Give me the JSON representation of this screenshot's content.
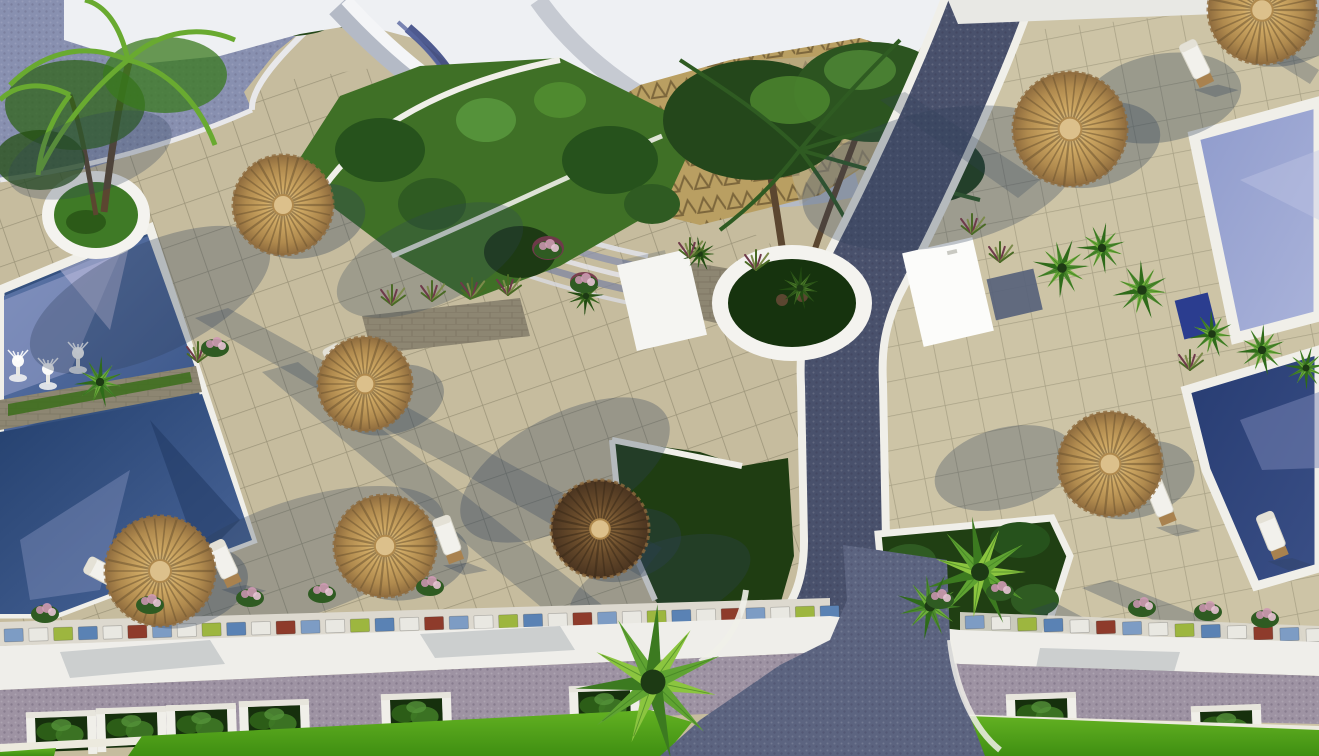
{
  "scene": {
    "type": "aerial-3d-render",
    "subject": "resort pool terrace, top-down view, sunny with long tree shadows"
  },
  "palette": {
    "tile": "#c6bc9e",
    "tile_right": "#cdc4a6",
    "grid_line": "rgba(62,60,40,0.5)",
    "path": "#49516c",
    "path_light": "#5c6480",
    "curb": "#f0efe9",
    "white": "#f4f3ef",
    "roof": "#b4bac6",
    "roof_hi": "#f4f5f7",
    "sky": "#eef0f3",
    "gold_paving": "#b99f62",
    "ramp": "#8890b0",
    "pool_upper_a": "#5d76a8",
    "pool_upper_b": "#3a5588",
    "pool_lower_a": "#24406e",
    "pool_lower_b": "#4c689c",
    "pool_right_a": "#8f9bcc",
    "pool_right_b": "#aab3da",
    "pool_right2_a": "#273c72",
    "pool_right2_b": "#3a4f86",
    "lawn_a": "#63b122",
    "lawn_b": "#3f8f12",
    "lawn_dark": "#1f3d12",
    "garden": "#3f7026",
    "bush_dark": "#26521c",
    "bush_mid": "#2f5b22",
    "bush_light": "#55923a",
    "thatch_rim": "#8f6c3e",
    "thatch_mid": "#cfa964",
    "thatch_hi": "#e3cf9d",
    "thatch_cap": "#dcc08b",
    "thatch_dark": "#6b4d2c",
    "trunk": "#5b4630",
    "stone": "#8d8672",
    "mauve": "#9e93a3",
    "shadow": "#2e4058",
    "flower_pink": "#c893ad",
    "mosaic_colors_note": "low wall of colored glass blocks",
    "towel_box_blue": "#2b3d8f"
  },
  "objects": {
    "umbrellas": [
      {
        "x": 283,
        "y": 205,
        "r": 50,
        "variant": "light"
      },
      {
        "x": 365,
        "y": 384,
        "r": 47,
        "variant": "light"
      },
      {
        "x": 385,
        "y": 546,
        "r": 51,
        "variant": "light"
      },
      {
        "x": 160,
        "y": 571,
        "r": 55,
        "variant": "light"
      },
      {
        "x": 600,
        "y": 529,
        "r": 49,
        "variant": "dark"
      },
      {
        "x": 1070,
        "y": 129,
        "r": 57,
        "variant": "light"
      },
      {
        "x": 1262,
        "y": 10,
        "r": 54,
        "variant": "light"
      },
      {
        "x": 1110,
        "y": 464,
        "r": 52,
        "variant": "light"
      }
    ],
    "loungers": [
      {
        "x": 340,
        "y": 366,
        "rot": -28
      },
      {
        "x": 448,
        "y": 538,
        "rot": -20
      },
      {
        "x": 106,
        "y": 574,
        "rot": -62
      },
      {
        "x": 224,
        "y": 562,
        "rot": -25
      },
      {
        "x": 1160,
        "y": 500,
        "rot": -22
      },
      {
        "x": 1272,
        "y": 534,
        "rot": -22
      },
      {
        "x": 1196,
        "y": 62,
        "rot": -26
      }
    ],
    "fountains": [
      {
        "x": 18,
        "y": 366
      },
      {
        "x": 48,
        "y": 374
      },
      {
        "x": 78,
        "y": 358
      }
    ],
    "hedge_planter_boxes": [
      {
        "x": 35,
        "y": 718
      },
      {
        "x": 105,
        "y": 714
      },
      {
        "x": 175,
        "y": 711
      },
      {
        "x": 248,
        "y": 707
      },
      {
        "x": 390,
        "y": 700
      },
      {
        "x": 578,
        "y": 692
      },
      {
        "x": 1015,
        "y": 700
      },
      {
        "x": 1200,
        "y": 712
      }
    ],
    "mosaic_wall": {
      "segments": [
        {
          "x0": 4,
          "y0": 629,
          "x1": 820,
          "y1": 606,
          "count": 34
        },
        {
          "x0": 965,
          "y0": 616,
          "x1": 1306,
          "y1": 629,
          "count": 14
        }
      ],
      "block_colors": [
        "#7d9cc4",
        "#e9e8e2",
        "#9db63f",
        "#5a82b4",
        "#e9e8e2",
        "#8e3b2b"
      ]
    },
    "flower_bushes": [
      {
        "x": 45,
        "y": 612
      },
      {
        "x": 150,
        "y": 603
      },
      {
        "x": 250,
        "y": 596
      },
      {
        "x": 322,
        "y": 592
      },
      {
        "x": 215,
        "y": 346
      },
      {
        "x": 548,
        "y": 248
      },
      {
        "x": 584,
        "y": 282
      },
      {
        "x": 940,
        "y": 598
      },
      {
        "x": 1000,
        "y": 590
      },
      {
        "x": 1142,
        "y": 606
      },
      {
        "x": 1208,
        "y": 610
      },
      {
        "x": 1265,
        "y": 617
      },
      {
        "x": 430,
        "y": 585
      }
    ],
    "grass_tufts": [
      {
        "x": 392,
        "y": 303
      },
      {
        "x": 432,
        "y": 299
      },
      {
        "x": 472,
        "y": 296
      },
      {
        "x": 508,
        "y": 293
      },
      {
        "x": 972,
        "y": 232
      },
      {
        "x": 1000,
        "y": 260
      },
      {
        "x": 198,
        "y": 360
      },
      {
        "x": 690,
        "y": 256
      },
      {
        "x": 756,
        "y": 268
      },
      {
        "x": 1190,
        "y": 368
      }
    ],
    "fan_palms": [
      {
        "x": 100,
        "y": 382,
        "r": 26,
        "tone": "mid"
      },
      {
        "x": 800,
        "y": 288,
        "r": 22,
        "tone": "dark"
      },
      {
        "x": 980,
        "y": 572,
        "r": 56,
        "tone": "light"
      },
      {
        "x": 930,
        "y": 606,
        "r": 34,
        "tone": "mid"
      },
      {
        "x": 1062,
        "y": 268,
        "r": 30,
        "tone": "mid"
      },
      {
        "x": 1102,
        "y": 248,
        "r": 26,
        "tone": "mid"
      },
      {
        "x": 1142,
        "y": 290,
        "r": 30,
        "tone": "mid"
      },
      {
        "x": 1212,
        "y": 334,
        "r": 24,
        "tone": "mid"
      },
      {
        "x": 1262,
        "y": 350,
        "r": 26,
        "tone": "mid"
      },
      {
        "x": 1306,
        "y": 368,
        "r": 22,
        "tone": "mid"
      },
      {
        "x": 653,
        "y": 682,
        "r": 78,
        "tone": "light"
      },
      {
        "x": 586,
        "y": 296,
        "r": 20,
        "tone": "dark"
      },
      {
        "x": 700,
        "y": 254,
        "r": 18,
        "tone": "dark"
      }
    ],
    "pools": {
      "count": 3,
      "left_pool_sections": 2,
      "left_pool_fountains": 3
    }
  },
  "fan_tones": {
    "light": [
      "#8bc53f",
      "#5fa332",
      "#3c7a20"
    ],
    "mid": [
      "#6fae3c",
      "#4c8a2e",
      "#2f6b1a"
    ],
    "dark": [
      "#4c7a2a",
      "#35601e",
      "#224a12"
    ]
  }
}
